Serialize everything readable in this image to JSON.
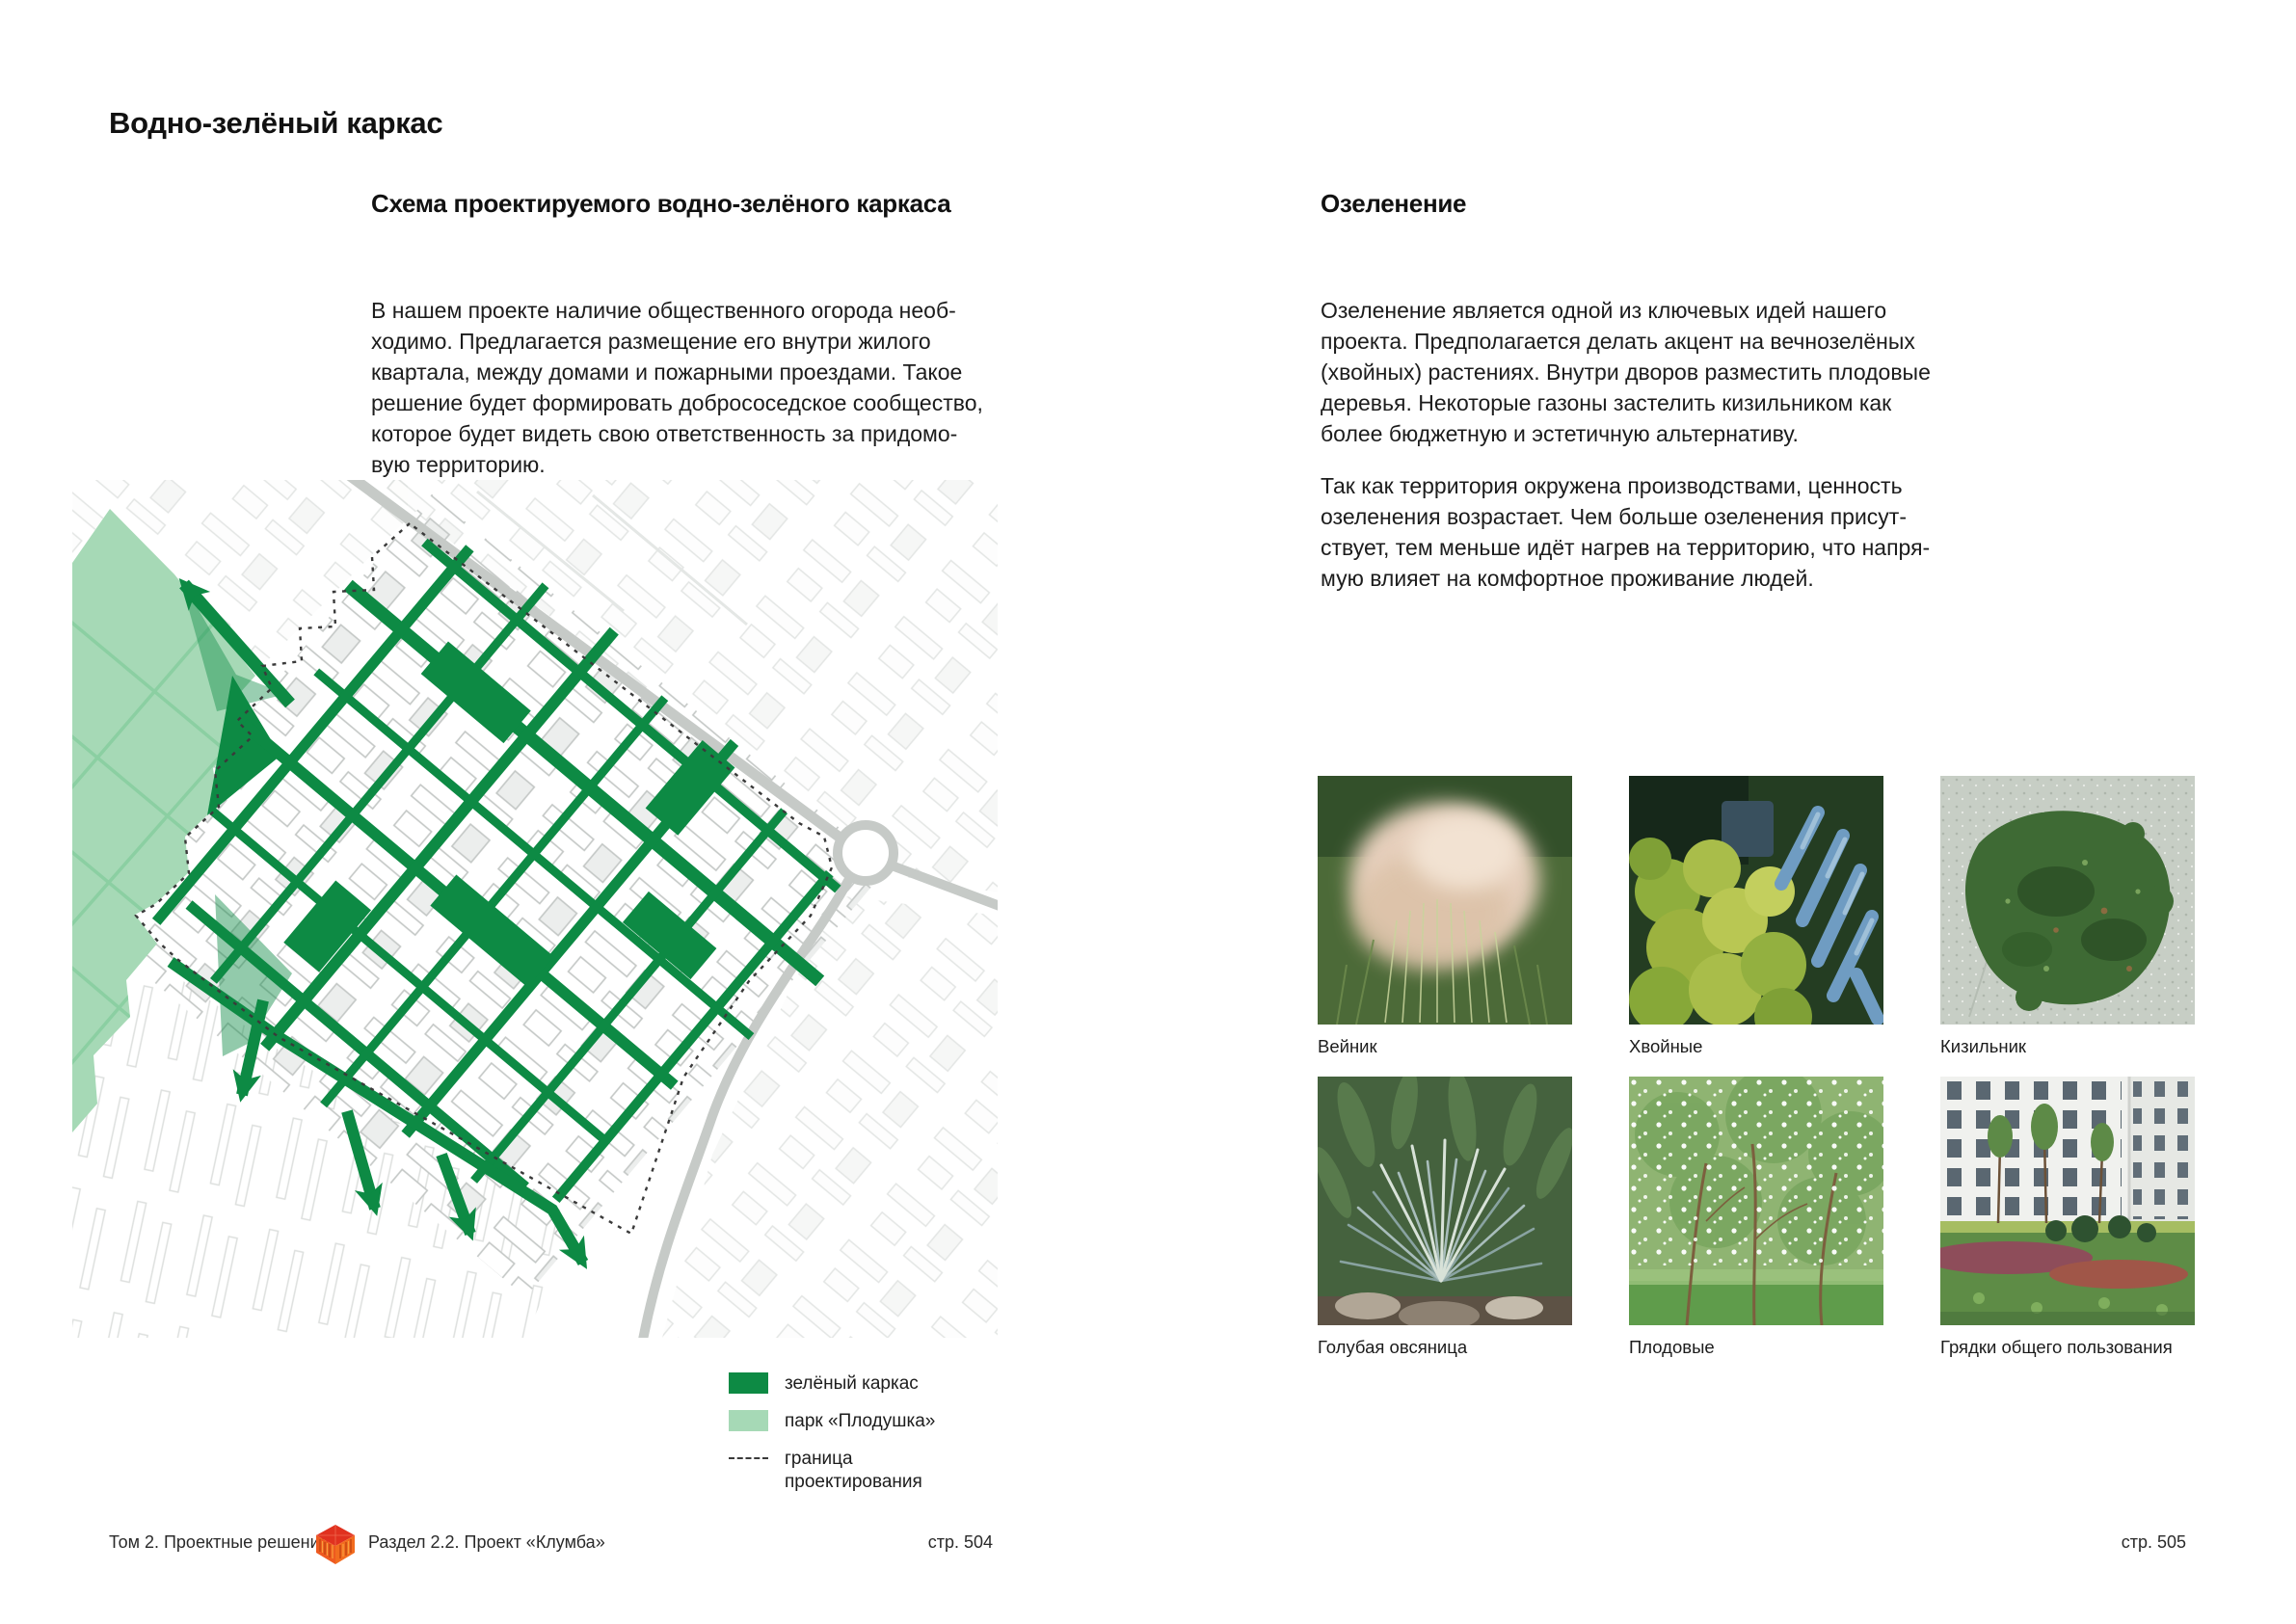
{
  "colors": {
    "framework_green": "#0d8a44",
    "park_green": "#a6d9b6",
    "park_grid_green": "#8bcfa2",
    "boundary_dash": "#3a3a3a",
    "logo_red": "#e0311f",
    "logo_orange": "#ef611f",
    "road_gray": "#c6cac7"
  },
  "page_title": "Водно-зелёный каркас",
  "left_column": {
    "heading": "Схема проектируемого водно-зелёного каркаса",
    "paragraph": "В нашем проекте наличие общественного огорода необ-\nходимо. Предлагается размещение его внутри жилого\nквартала, между домами и пожарными проездами. Такое\nрешение будет формировать добрососедское сообщество,\nкоторое будет видеть свою ответственность за придомо-\nвую территорию."
  },
  "right_column": {
    "heading": "Озеленение",
    "paragraph1": "Озеленение является одной из ключевых идей нашего\nпроекта. Предполагается делать акцент на вечнозелёных\n(хвойных) растениях. Внутри дворов разместить плодовые\nдеревья. Некоторые газоны застелить кизильником как\nболее бюджетную и эстетичную альтернативу.",
    "paragraph2": "Так как территория окружена производствами, ценность\nозеленения возрастает. Чем больше озеленения присут-\nствует, тем меньше идёт нагрев на территорию, что напря-\nмую влияет на комфортное проживание людей."
  },
  "legend": {
    "items": [
      {
        "label": "зелёный каркас",
        "swatch": "green"
      },
      {
        "label": "парк «Плодушка»",
        "swatch": "light-green"
      },
      {
        "label": "граница\nпроектирования",
        "swatch": "dashed"
      }
    ]
  },
  "photos": [
    {
      "caption": "Вейник"
    },
    {
      "caption": "Хвойные"
    },
    {
      "caption": "Кизильник"
    },
    {
      "caption": "Голубая овсяница"
    },
    {
      "caption": "Плодовые"
    },
    {
      "caption": "Грядки общего пользования"
    }
  ],
  "footer": {
    "volume": "Том 2. Проектные решения",
    "section": "Раздел 2.2. Проект «Клумба»",
    "page_left": "стр. 504",
    "page_right": "стр. 505"
  }
}
